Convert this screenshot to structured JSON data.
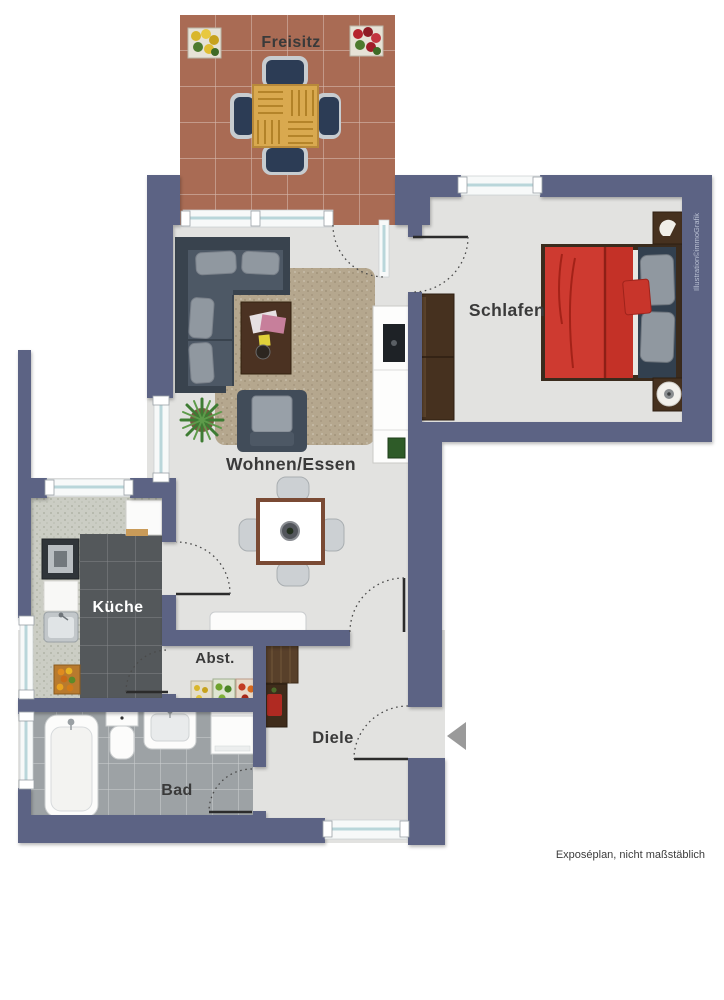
{
  "meta": {
    "caption": "Exposéplan, nicht maßstäblich",
    "credit": "Illustration©immoGrafik",
    "plan_type": "apartment floor plan",
    "entrance_symbol": "arrow-left"
  },
  "rooms": [
    {
      "id": "freisitz",
      "label": "Freisitz"
    },
    {
      "id": "schlafen",
      "label": "Schlafen"
    },
    {
      "id": "wohnen_essen",
      "label": "Wohnen/Essen"
    },
    {
      "id": "kueche",
      "label": "Küche"
    },
    {
      "id": "abst",
      "label": "Abst."
    },
    {
      "id": "diele",
      "label": "Diele"
    },
    {
      "id": "bad",
      "label": "Bad"
    }
  ],
  "palette": {
    "wall": "#5c6384",
    "floor": "#e2e2e0",
    "terrace": "#a96b54",
    "kitchenFloor": "#54585b",
    "bathFloor": "#9da2a5",
    "counter": "#cbcdc4",
    "rug": "#b5a78e",
    "bedRed": "#ce3a30",
    "woodDark": "#46311f",
    "tableWood": "#7a4a34",
    "sofa": "#47525f",
    "cushion": "#9098a0",
    "glass": "#b9d6da",
    "labelColor": "#3a3a3a",
    "creditColor": "#b8bfd2",
    "arrowGray": "#9a9a9a",
    "plantGreen": "#3e7c33"
  }
}
